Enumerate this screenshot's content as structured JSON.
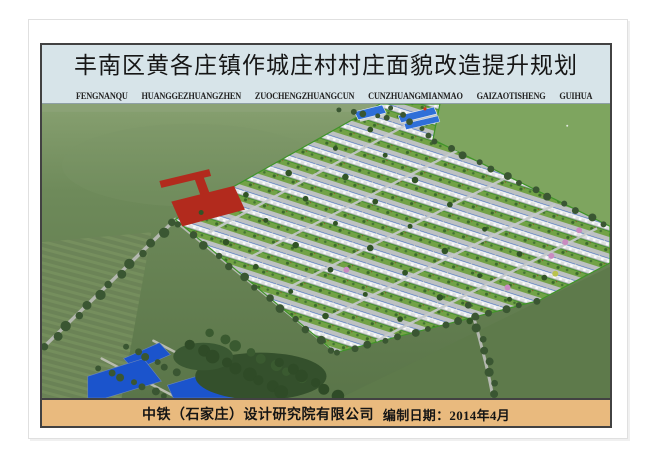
{
  "header": {
    "title": "丰南区黄各庄镇作城庄村村庄面貌改造提升规划",
    "pinyin": "FENGNANQU HUANGGEZHUANGZHEN ZUOCHENGZHUANGCUN CUNZHUANGMIANMAO GAIZAOTISHENG GUIHUA",
    "right_caption": "作城庄村规划效果图"
  },
  "footer": {
    "company": "中铁（石家庄）设计研究院有限公司",
    "date": "编制日期：2014年4月"
  },
  "colors": {
    "page_bg": "#ffffff",
    "title_band_bg": "#d7e4e9",
    "footer_band_bg": "#e9ba7e",
    "border_dark": "#424242",
    "field_green": "#6b8758",
    "bright_field_green": "#7ea55f",
    "tree_green": "#3a5632",
    "house_row_gray": "#dde0e0",
    "street_gray": "#bdc1c2",
    "yard_green": "#72a246",
    "pond_blue": "#1b54cc",
    "road_red": "#b22a1d",
    "roof_blue": "#2f6fd8",
    "blossom_pink": "#c98bc0"
  }
}
